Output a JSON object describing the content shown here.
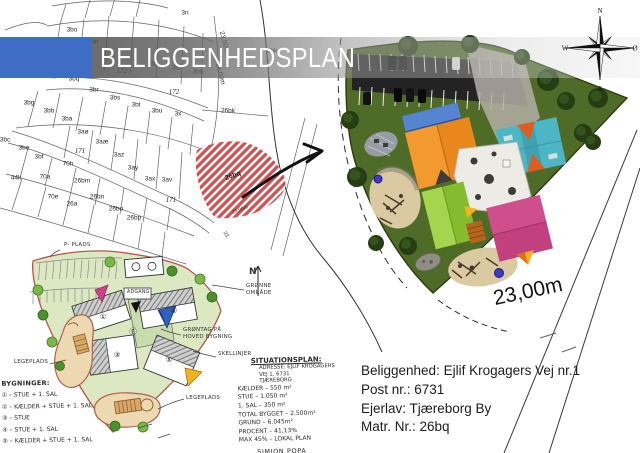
{
  "banner": {
    "title": "BELIGGENHEDSPLAN",
    "accent_color": "#3f6cc5",
    "band_color": "#6e6e6e"
  },
  "compass": {
    "north": "N",
    "east": "Ø",
    "south": "S",
    "west": "W"
  },
  "cadastral_map": {
    "labels": [
      "3n",
      "3bo",
      "3bn",
      "3bk",
      "3bi",
      "3bh",
      "3bp",
      "3bq",
      "3br",
      "172",
      "172",
      "3bg",
      "3bb",
      "3ba",
      "3bs",
      "3bt",
      "3bu",
      "3x",
      "3aø",
      "3aæ",
      "171",
      "3az",
      "3ay",
      "3ax",
      "3av",
      "171",
      "3bc",
      "3be",
      "3bf",
      "70h",
      "70a",
      "44k",
      "26bm",
      "70e",
      "26a",
      "26bn",
      "26bo",
      "26bp",
      "26bk",
      "6bk",
      "23,00m",
      "23,00m",
      "23,00m",
      "23,"
    ],
    "highlighted_parcel": {
      "label": "26bq",
      "hatch_color": "#d84040"
    }
  },
  "site_render": {
    "dimension_label": "23,00m",
    "colors": {
      "grass": "#4f6b28",
      "parking": "#232323",
      "roof_blue": "#3d70c2",
      "roof_orange": "#e8871c",
      "roof_teal": "#4db6c4",
      "roof_lime": "#94c93d",
      "roof_magenta": "#c1417f",
      "building_white": "#edebe6",
      "sand": "#dbc9a1",
      "tree": "#263c12",
      "accent_yellow": "#f3b31d"
    }
  },
  "sketch": {
    "labels": {
      "parking": "P- PLADS",
      "access": "ADGANG",
      "north": "N",
      "green_area": "GRØNNE\nOMRÅDE",
      "green_roof": "GRØNTAG PÅ\nHOVED BYGNING",
      "boundary": "SKELLINJER",
      "playground_left": "LEGEPLADS",
      "playground_right": "LEGEPLADS"
    },
    "marks": {
      "b1": "①",
      "b3": "③",
      "b4": "④",
      "b5": "⑤",
      "center": "Ⓔ"
    },
    "legend": {
      "title": "BYGNINGER:",
      "items": [
        "① – STUE + 1. SAL",
        "② – KÆLDER + STUE + 1. SAL",
        "③ – STUE",
        "④ – STUE + 1. SAL",
        "⑤ – KÆLDER + STUE + 1. SAL"
      ]
    },
    "notes": {
      "title": "SITUATIONSPLAN:",
      "address": [
        "ADRESSE: EJLIF KROGAGERS",
        "VEJ 1, 6731",
        "TJÆREBORG"
      ],
      "lines": [
        "KÆLDER – 550 m²",
        "STUE – 1.050 m²",
        "1. SAL – 350 m²",
        "TOTAL BYGGET – 2.500m²",
        "GRUND – 6.045m²",
        "PROCENT – 41,13%",
        "MAX 45% – LOKAL PLAN"
      ],
      "signature": "SIMION POPA"
    }
  },
  "property_info": {
    "lines": [
      "Beliggenhed: Ejlif Krogagers Vej nr.1",
      "Post nr.: 6731",
      "Ejerlav: Tjæreborg By",
      "Matr. Nr.: 26bq"
    ]
  }
}
